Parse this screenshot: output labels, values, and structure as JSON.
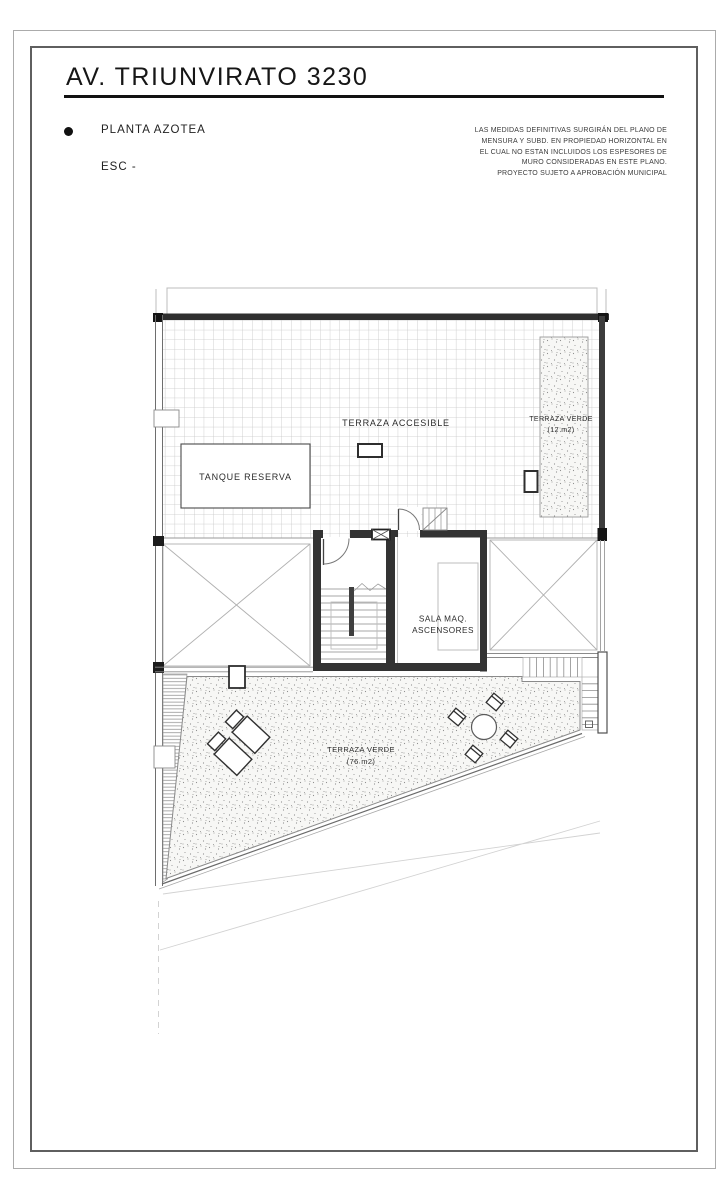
{
  "sheet": {
    "title": "AV. TRIUNVIRATO 3230",
    "plan_name": "PLANTA AZOTEA",
    "scale_label": "ESC -",
    "notes": [
      "LAS MEDIDAS DEFINITIVAS SURGIRÁN DEL PLANO DE",
      "MENSURA Y SUBD. EN PROPIEDAD HORIZONTAL EN",
      "EL CUAL NO ESTAN INCLUIDOS LOS ESPESORES DE",
      "MURO CONSIDERADAS EN ESTE PLANO.",
      "PROYECTO SUJETO A APROBACIÓN MUNICIPAL"
    ]
  },
  "plan": {
    "labels": {
      "terraza_accesible": "TERRAZA ACCESIBLE",
      "tanque_reserva": "TANQUE RESERVA",
      "terraza_verde_12_name": "TERRAZA VERDE",
      "terraza_verde_12_area": "(12 m2)",
      "sala_maq_line1": "SALA MAQ.",
      "sala_maq_line2": "ASCENSORES",
      "terraza_verde_76_name": "TERRAZA VERDE",
      "terraza_verde_76_area": "(76 m2)"
    },
    "colors": {
      "ink": "#2b2b2b",
      "wall_dark": "#333333",
      "grid_line": "#c6c6c6",
      "light_line": "#b0b0b0",
      "paper": "#ffffff"
    }
  }
}
